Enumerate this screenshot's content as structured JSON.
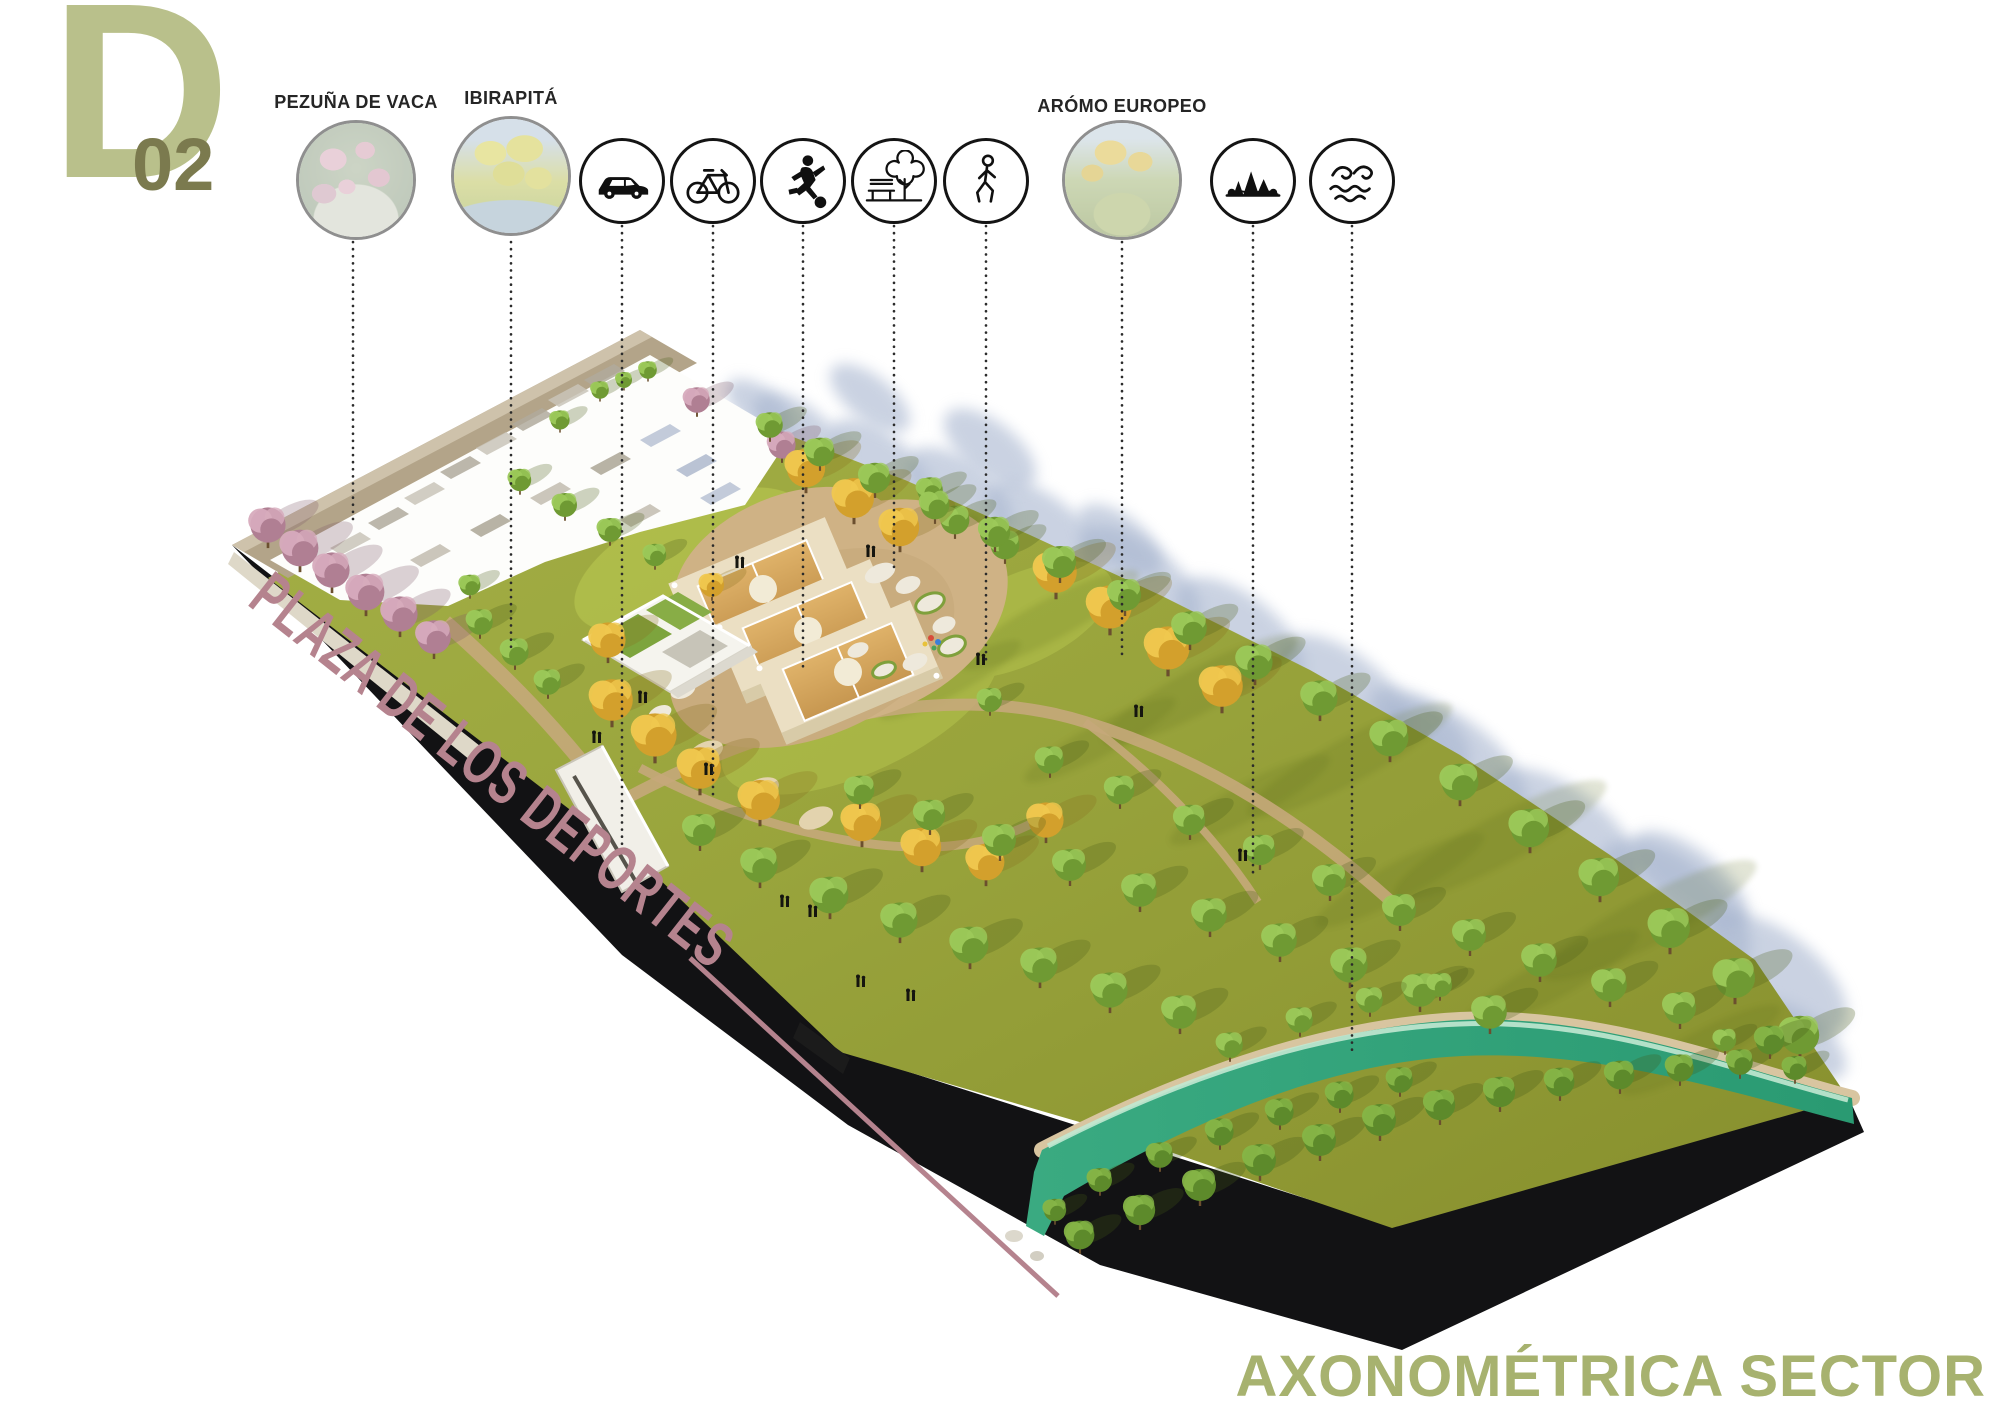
{
  "sheet": {
    "code_letter": "D",
    "code_number": "02"
  },
  "legend": {
    "items": [
      {
        "kind": "photo",
        "label": "PEZUÑA DE VACA"
      },
      {
        "kind": "photo",
        "label": "IBIRAPITÁ"
      },
      {
        "kind": "icon",
        "icon": "car-icon"
      },
      {
        "kind": "icon",
        "icon": "bicycle-icon"
      },
      {
        "kind": "icon",
        "icon": "soccer-player-icon"
      },
      {
        "kind": "icon",
        "icon": "bench-tree-icon"
      },
      {
        "kind": "icon",
        "icon": "walking-person-icon"
      },
      {
        "kind": "photo",
        "label": "ARÓMO EUROPEO"
      },
      {
        "kind": "icon",
        "icon": "forest-landscape-icon"
      },
      {
        "kind": "icon",
        "icon": "water-waves-icon"
      }
    ]
  },
  "plan": {
    "site_label": "PLAZA DE LOS DEPORTES"
  },
  "footer": {
    "view_title": "AXONOMÉTRICA SECTOR"
  },
  "colors": {
    "accent_olive": "#a7b26f",
    "accent_mauve": "#b5838e",
    "logo_light": "#b9c08b",
    "logo_dark": "#7b7a4e",
    "water_teal": "#2ea47b",
    "grass_olive": "#96a238"
  }
}
